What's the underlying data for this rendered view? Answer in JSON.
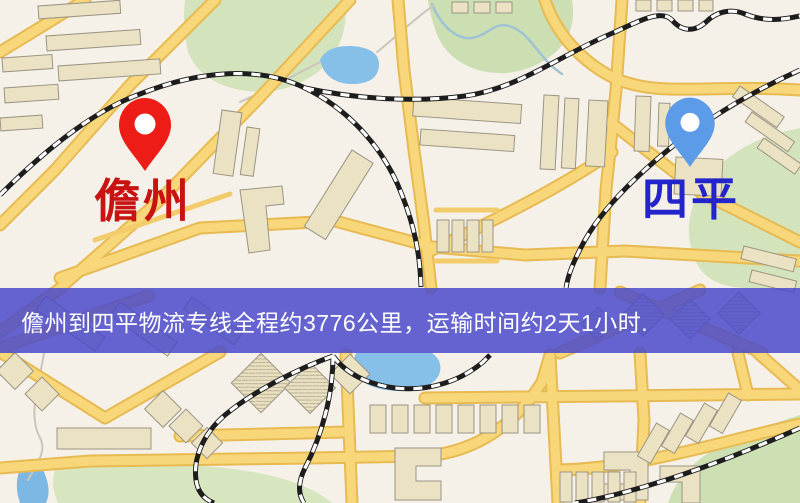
{
  "banner": {
    "text": "儋州到四平物流专线全程约3776公里，运输时间约2天1小时.",
    "origin": "儋州",
    "destination": "四平",
    "distance_km": "3776",
    "duration": "2天1小时",
    "background_color": "#4a4aca",
    "text_color": "#ffffff"
  },
  "map": {
    "markers": [
      {
        "id": "origin",
        "label": "儋州",
        "icon": "map-pin-icon",
        "pin_color": "#ee1c16",
        "label_color": "#c91212"
      },
      {
        "id": "destination",
        "label": "四平",
        "icon": "map-pin-icon",
        "pin_color": "#5b9be8",
        "label_color": "#2424cc"
      }
    ]
  },
  "palette": {
    "map_background": "#f5f1e8",
    "road_fill": "#f8d77a",
    "road_edge": "#e7ba52",
    "building": "#ebe2c4",
    "building_outline": "#9b9484",
    "green_area": "#d3e4bd",
    "water": "#86bfe8",
    "railway": "#1d1d1d"
  }
}
